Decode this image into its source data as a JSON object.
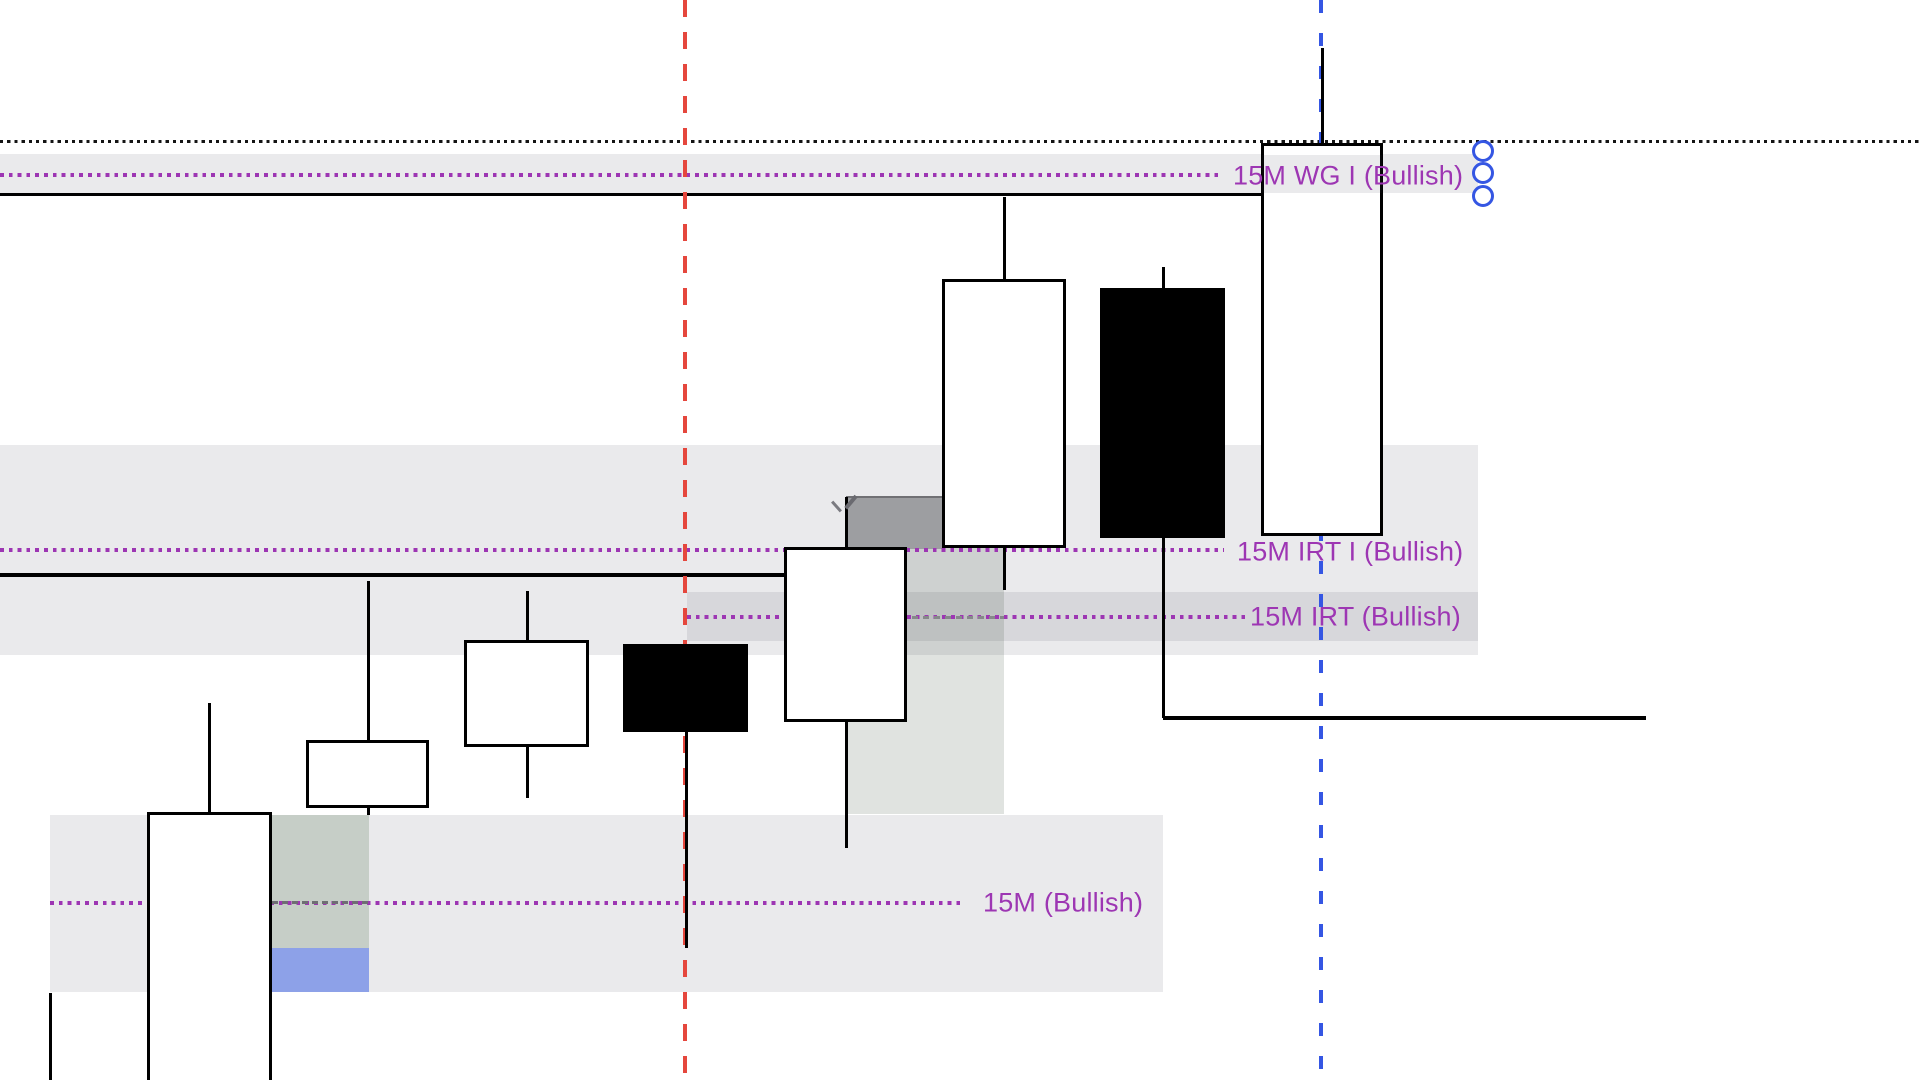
{
  "chart_data": {
    "type": "candlestick",
    "canvas": {
      "width": 1922,
      "height": 1080
    },
    "timeframe_note": "15M",
    "labels": {
      "wg": {
        "text": "15M WG I (Bullish)"
      },
      "irt_i": {
        "text": "15M IRT I (Bullish)"
      },
      "irt": {
        "text": "15M IRT (Bullish)"
      },
      "m15": {
        "text": "15M (Bullish)"
      }
    },
    "colors": {
      "label_purple": "#9d36b3",
      "level_purple": "#9d36b3",
      "red_vline": "#e5473d",
      "blue_vline": "#3556e3",
      "handle_stroke": "#3556e3",
      "candle_up_fill": "#ffffff",
      "candle_down_fill": "#000000",
      "candle_border": "#000000",
      "zone_gray": "rgba(60,60,75,0.105)",
      "zone_green": "rgba(75,110,70,0.22)",
      "zone_column": "rgba(62,82,62,0.16)",
      "dark_box": "#9d9ea1",
      "blue_box": "#8da1e8"
    },
    "zones": [
      {
        "name": "wg-zone",
        "x": 0,
        "y": 154,
        "w": 1478,
        "h": 39,
        "fill": "rgba(60,60,75,0.105)"
      },
      {
        "name": "irt-i-zone",
        "x": 0,
        "y": 445,
        "w": 1478,
        "h": 210,
        "fill": "rgba(60,60,75,0.105)"
      },
      {
        "name": "irt-zone",
        "x": 687,
        "y": 592,
        "w": 791,
        "h": 49,
        "fill": "rgba(60,60,75,0.105)"
      },
      {
        "name": "fvg-column-zone",
        "x": 846,
        "y": 546,
        "w": 158,
        "h": 268,
        "fill": "rgba(62,82,62,0.16)"
      },
      {
        "name": "orderblock-dark-box",
        "x": 846,
        "y": 496,
        "w": 96,
        "h": 51,
        "fill": "#9d9ea1",
        "border_top": "2px solid #707074"
      },
      {
        "name": "m15-zone",
        "x": 50,
        "y": 815,
        "w": 1113,
        "h": 177,
        "fill": "rgba(60,60,75,0.105)"
      },
      {
        "name": "m15-overlap-zone",
        "x": 272,
        "y": 815,
        "w": 97,
        "h": 133,
        "fill": "rgba(75,110,70,0.22)"
      },
      {
        "name": "m15-mitigation-blue-box",
        "x": 272,
        "y": 948,
        "w": 97,
        "h": 44,
        "fill": "#8da1e8"
      }
    ],
    "hlines": [
      {
        "name": "top-dotted-line",
        "y": 141,
        "x1": 0,
        "x2": 1922,
        "t": 3,
        "color": "#141414",
        "dash": [
          3.2,
          7.2
        ]
      },
      {
        "name": "wg-dotted-line",
        "y": 175,
        "x1": 0,
        "x2": 1218,
        "t": 3.5,
        "color": "#9d36b3",
        "dash": [
          3.8,
          8.8
        ]
      },
      {
        "name": "wg-base-line",
        "y": 194,
        "x1": 0,
        "x2": 1261,
        "t": 3,
        "color": "#000000"
      },
      {
        "name": "irt-i-dotted-line",
        "y": 550,
        "x1": 0,
        "x2": 1224,
        "t": 3.5,
        "color": "#9d36b3",
        "dash": [
          3.8,
          8.8
        ]
      },
      {
        "name": "irt-i-base-line",
        "y": 575,
        "x1": 0,
        "x2": 784,
        "t": 3.5,
        "color": "#000000"
      },
      {
        "name": "irt-dotted-line",
        "y": 617,
        "x1": 687,
        "x2": 1245,
        "t": 3.5,
        "color": "#9d36b3",
        "dash": [
          3.8,
          8.8
        ]
      },
      {
        "name": "irt-gray-dashed-line",
        "y": 617,
        "x1": 846,
        "x2": 1004,
        "t": 3,
        "color": "#86888a",
        "dash": [
          6,
          11
        ]
      },
      {
        "name": "m15-dotted-line",
        "y": 903,
        "x1": 50,
        "x2": 965,
        "t": 3.5,
        "color": "#9d36b3",
        "dash": [
          3.8,
          8.8
        ]
      },
      {
        "name": "m15-gray-dashed-line",
        "y": 902,
        "x1": 272,
        "x2": 369,
        "t": 3,
        "color": "#6e6e73",
        "dash": [
          6,
          10
        ]
      },
      {
        "name": "swing-low-line",
        "y": 718,
        "x1": 1163,
        "x2": 1646,
        "t": 3.5,
        "color": "#000000"
      }
    ],
    "vlines": [
      {
        "name": "red-dashed-vline",
        "x": 685,
        "y1": 0,
        "y2": 1080,
        "t": 3.5,
        "color": "#e5473d",
        "dash": [
          17,
          32
        ]
      },
      {
        "name": "blue-dashed-vline",
        "x": 1321,
        "y1": 0,
        "y2": 1080,
        "t": 4,
        "color": "#3556e3",
        "dash": [
          13,
          33
        ]
      }
    ],
    "candles": [
      {
        "name": "candle-1",
        "body": null,
        "wick_x": 50,
        "wick_top": 993,
        "wick_bottom": 1085,
        "fill": "white"
      },
      {
        "name": "candle-2",
        "left": 147,
        "right": 272,
        "top": 812,
        "bottom": 1085,
        "fill": "white",
        "wick_x": 209,
        "wick_top": 703,
        "wick_bottom": 1085
      },
      {
        "name": "candle-3",
        "left": 306,
        "right": 429,
        "top": 740,
        "bottom": 808,
        "fill": "white",
        "wick_x": 368,
        "wick_top": 581,
        "wick_bottom": 815
      },
      {
        "name": "candle-4",
        "left": 464,
        "right": 589,
        "top": 640,
        "bottom": 747,
        "fill": "white",
        "wick_x": 527,
        "wick_top": 591,
        "wick_bottom": 798
      },
      {
        "name": "candle-5",
        "left": 623,
        "right": 748,
        "top": 644,
        "bottom": 732,
        "fill": "black",
        "wick_x": 686,
        "wick_top": 644,
        "wick_bottom": 948
      },
      {
        "name": "candle-6",
        "left": 784,
        "right": 907,
        "top": 547,
        "bottom": 722,
        "fill": "white",
        "wick_x": 846,
        "wick_top": 497,
        "wick_bottom": 848
      },
      {
        "name": "candle-7",
        "left": 942,
        "right": 1066,
        "top": 279,
        "bottom": 548,
        "fill": "white",
        "wick_x": 1004,
        "wick_top": 197,
        "wick_bottom": 590
      },
      {
        "name": "candle-8",
        "left": 1100,
        "right": 1225,
        "top": 288,
        "bottom": 538,
        "fill": "black",
        "wick_x": 1163,
        "wick_top": 267,
        "wick_bottom": 718
      },
      {
        "name": "candle-9",
        "left": 1261,
        "right": 1383,
        "top": 143,
        "bottom": 536,
        "fill": "white",
        "wick_x": 1322,
        "wick_top": 48,
        "wick_bottom": 536
      }
    ],
    "overlays": [
      {
        "name": "wg-zone-over-candle",
        "x": 1262,
        "y": 155,
        "w": 120,
        "h": 38,
        "fill": "rgba(60,60,75,0.105)"
      }
    ],
    "cursor_marks": [
      {
        "name": "cursor-stroke-left",
        "x": 836,
        "y": 506,
        "len": 13,
        "w": 3,
        "rot": -42,
        "color": "#7a7a80"
      },
      {
        "name": "cursor-stroke-right",
        "x": 851,
        "y": 502,
        "len": 16,
        "w": 3.5,
        "rot": 40,
        "color": "#6a6a70"
      }
    ],
    "handles": {
      "cx": 1483,
      "cys": [
        151,
        173,
        196
      ],
      "r": 11,
      "stroke": "#3556e3",
      "stroke_w": 3,
      "fill": "#ffffff"
    }
  }
}
